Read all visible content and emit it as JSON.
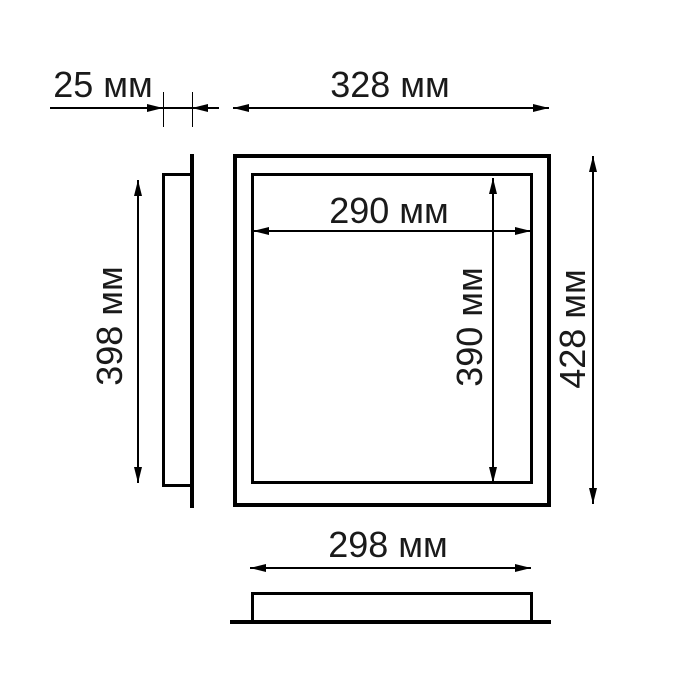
{
  "drawing": {
    "type": "technical-dimension-drawing",
    "unit": "мм",
    "colors": {
      "background": "#ffffff",
      "line": "#000000",
      "text": "#1a1a1a"
    },
    "views": {
      "front": "front view: outer frame with inner opening",
      "side": "left side profile with mounting flange",
      "bottom": "bottom profile with mounting flange"
    },
    "dimensions": {
      "depth": {
        "label": "25 мм",
        "value_mm": 25
      },
      "outer_width": {
        "label": "328 мм",
        "value_mm": 328
      },
      "inner_width": {
        "label": "290 мм",
        "value_mm": 290
      },
      "inner_height": {
        "label": "390 мм",
        "value_mm": 390
      },
      "outer_height": {
        "label": "428 мм",
        "value_mm": 428
      },
      "side_height": {
        "label": "398 мм",
        "value_mm": 398
      },
      "bottom_width": {
        "label": "298 мм",
        "value_mm": 298
      }
    }
  }
}
